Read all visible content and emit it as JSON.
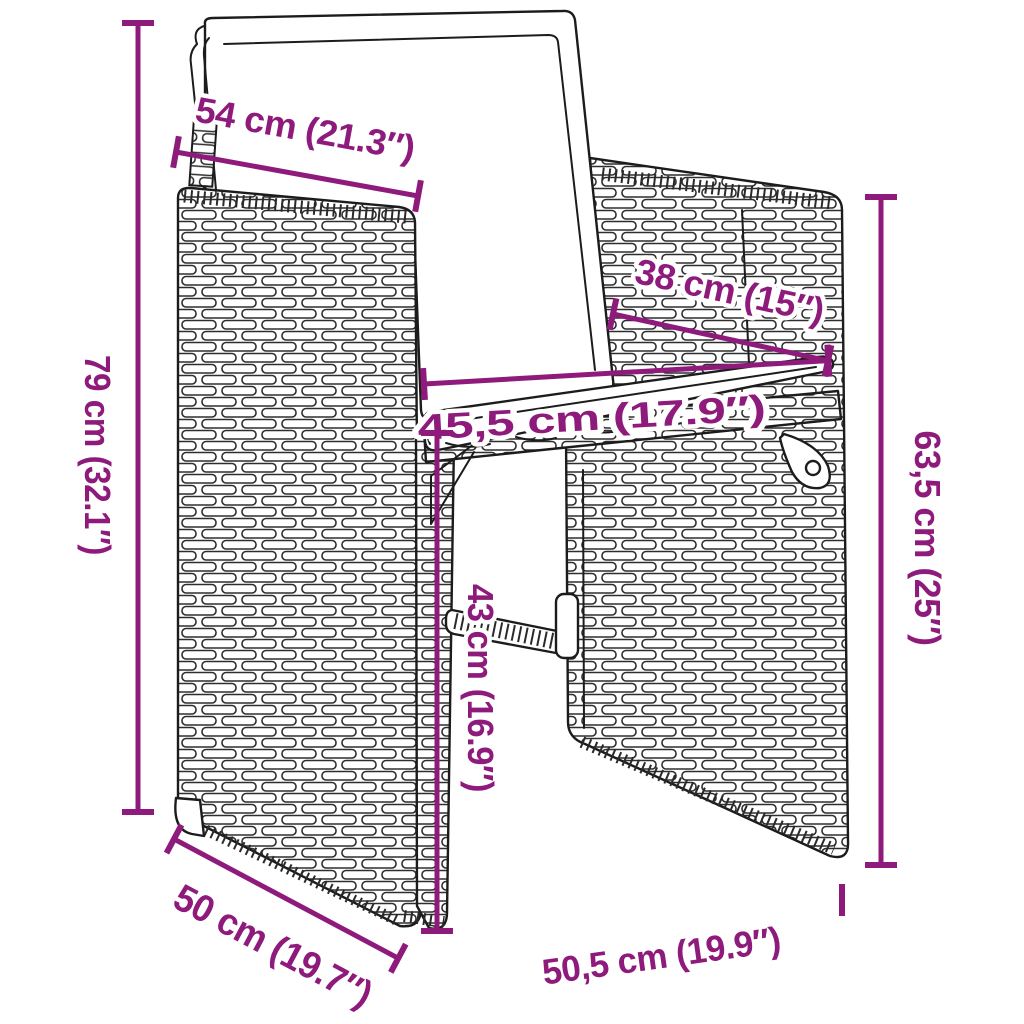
{
  "image": {
    "kind": "product dimension diagram",
    "subject": "poly rattan garden armchair with back and seat cushions (line drawing)"
  },
  "colors": {
    "dimension": "#8E1B7C",
    "outline": "#1c1c1c",
    "background": "#ffffff"
  },
  "dimensions": {
    "back_width_top": "54 cm (21.3″)",
    "seat_depth": "38 cm (15″)",
    "total_height_left": "79 cm (32.1″)",
    "seat_width": "45,5 cm (17.9″)",
    "backrest_height_right": "63,5 cm (25″)",
    "seat_height_center": "43 cm (16.9″)",
    "depth_bottom_left": "50 cm (19.7″)",
    "width_bottom_right": "50,5 cm (19.9″)"
  }
}
